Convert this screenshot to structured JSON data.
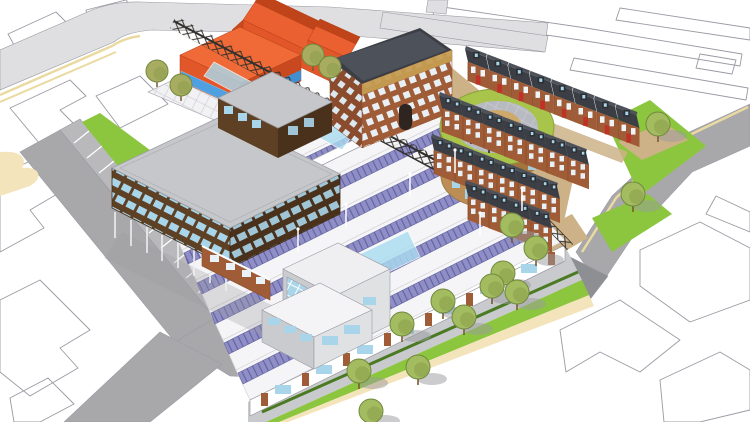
{
  "scene": {
    "description": "Aerial isometric architectural massing render: solar sawtooth-roof sheds, timber office on stilts, oval green-roof pavilion, dark-roof terraced housing, orange existing buildings, tree-lined promenade, grey streets with cream kerb lines, white line-drawing context plan.",
    "elements": [
      "context-building-outlines",
      "perimeter-roads",
      "parking-bays",
      "grass-verges",
      "entry-plaza",
      "glass-canopy",
      "pergola-trusses",
      "orange-existing-buildings",
      "brick-apartment-block",
      "terraced-houses",
      "oval-green-roof-pavilion",
      "solar-sawtooth-sheds",
      "glass-atria",
      "footbridge",
      "timber-office-on-stilts",
      "brick-ground-floor-wing",
      "corner-pavilion",
      "tree-lined-promenade",
      "street-trees",
      "light-posts"
    ]
  },
  "counts": {
    "solar_roof_rows": 7,
    "promenade_trees": 8,
    "north_terrace_houses": 8,
    "courtyard_terrace_rows": 3,
    "courtyard_terrace_houses": 17,
    "parking_bays": 11,
    "verge_trees": 4,
    "courtyard_trees": 3,
    "plaza_trees": 2,
    "light_posts": 6
  },
  "colors": {
    "outline": "#9a9ba3",
    "roadLight": "#dfdfe1",
    "roadMid": "#a8a8ab",
    "roadPark": "#b9b9bc",
    "roadDark": "#8e8f93",
    "laneTan": "#ead9a0",
    "sidewalkTan": "#f4e4bb",
    "pave": "#c9cace",
    "paveRing": "#b8bac2",
    "courtyardPave": "#c6c9cf",
    "buff": "#cdb287",
    "grass": "#8bc63e",
    "hedge": "#4a7a22",
    "treeFill": "#a4bc60",
    "treeDark": "#82994a",
    "treeEdge": "#72893f",
    "oliveFill": "#a8ac60",
    "trunk": "#7a5a35",
    "shadow": "#9b9b9e",
    "solar": "#8f8ec6",
    "solarDark": "#62619e",
    "shedRoof": "#f5f5f8",
    "glass": "#aadcf0",
    "glassBlue": "#4fa0e0",
    "winBlue": "#a9d5ea",
    "winFrame": "#eef4f8",
    "pergola": "#32302c",
    "timber": "#5e4124",
    "timberDark": "#49311b",
    "brick": "#a05c36",
    "brickDark": "#8a4c2c",
    "roofDark": "#3b3e44",
    "roofDarkTop": "#4d515a",
    "dormer": "#2c2f34",
    "door": "#c03226",
    "orangeWall": "#e2572a",
    "orangeWallDark": "#c8491f",
    "orangeTop": "#ef6a36",
    "orangeRoofLight": "#ea6030",
    "orangeRoofDark": "#c04419",
    "ovalWall": "#bc8e55",
    "ovalWallDark": "#a3743c",
    "ovalWallLight": "#cfa969",
    "greenRing": "#a9c44a",
    "gold": "#c59c52",
    "roofGray": "#c6c7ca",
    "wallGray": "#c9cbce",
    "wallGrayLight": "#dfe1e3",
    "white": "#ffffff"
  }
}
